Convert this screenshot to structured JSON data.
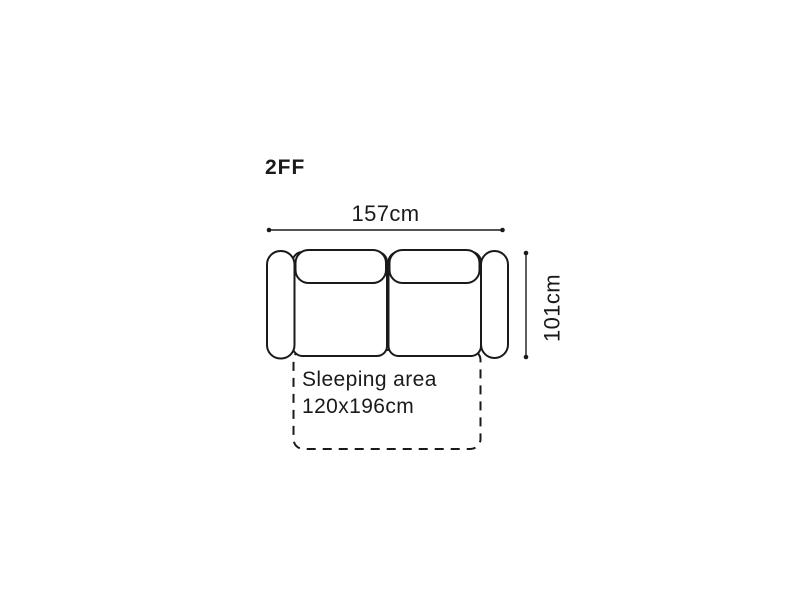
{
  "diagram": {
    "title": "2FF",
    "dimensions": {
      "width_label": "157cm",
      "depth_label": "101cm"
    },
    "sleeping_area": {
      "line1": "Sleeping area",
      "line2": "120x196cm"
    },
    "icons": {
      "width_dimension_line": "double-ended-dot-line-horizontal",
      "depth_dimension_line": "double-ended-dot-line-vertical"
    },
    "colors": {
      "line": "#1a1a1a",
      "text": "#1a1a1a",
      "background": "#ffffff"
    }
  }
}
